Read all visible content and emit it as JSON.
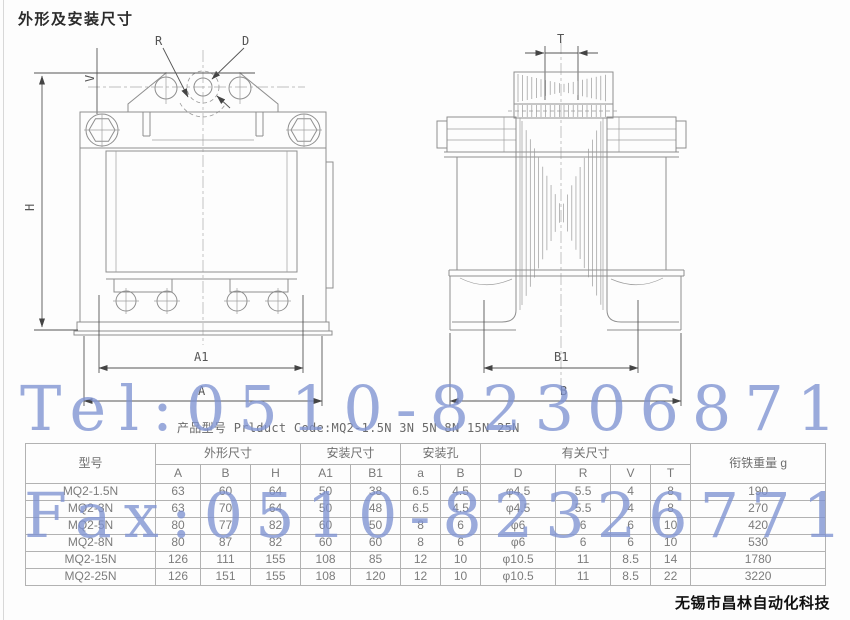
{
  "page": {
    "title": "外形及安装尺寸",
    "product_code_line": "产品型号 Prlduct Code:MQ2-1.5N 3N 5N 8N 15N 25N",
    "watermark_tel": "Tel:0510-82306871",
    "watermark_fax": "Fax:0510-82326771",
    "watermark_color": "#7f93d2",
    "footer": "无锡市昌林自动化科技"
  },
  "drawing": {
    "labels": {
      "h": "H",
      "v": "V",
      "r": "R",
      "d": "D",
      "a1": "A1",
      "a": "A",
      "t": "T",
      "b1": "B1",
      "b": "B"
    }
  },
  "table": {
    "header_groups": [
      {
        "label": "型号",
        "rowspan": 2
      },
      {
        "label": "外形尺寸",
        "colspan": 3
      },
      {
        "label": "安装尺寸",
        "colspan": 2
      },
      {
        "label": "安装孔",
        "colspan": 2
      },
      {
        "label": "有关尺寸",
        "colspan": 4
      },
      {
        "label": "衔铁重量 g",
        "rowspan": 2
      }
    ],
    "sub_headers": [
      "A",
      "B",
      "H",
      "A1",
      "B1",
      "a",
      "B",
      "D",
      "R",
      "V",
      "T"
    ],
    "rows": [
      {
        "model": "MQ2-1.5N",
        "values": [
          "63",
          "60",
          "64",
          "50",
          "38",
          "6.5",
          "4.5",
          "φ4.5",
          "5.5",
          "4",
          "8",
          "190"
        ]
      },
      {
        "model": "MQ2-3N",
        "values": [
          "63",
          "70",
          "64",
          "50",
          "48",
          "6.5",
          "4.5",
          "φ4.5",
          "5.5",
          "4",
          "8",
          "270"
        ]
      },
      {
        "model": "MQ2-5N",
        "values": [
          "80",
          "77",
          "82",
          "60",
          "50",
          "8",
          "6",
          "φ6",
          "6",
          "6",
          "10",
          "420"
        ]
      },
      {
        "model": "MQ2-8N",
        "values": [
          "80",
          "87",
          "82",
          "60",
          "60",
          "8",
          "6",
          "φ6",
          "6",
          "6",
          "10",
          "530"
        ]
      },
      {
        "model": "MQ2-15N",
        "values": [
          "126",
          "111",
          "155",
          "108",
          "85",
          "12",
          "10",
          "φ10.5",
          "11",
          "8.5",
          "14",
          "1780"
        ]
      },
      {
        "model": "MQ2-25N",
        "values": [
          "126",
          "151",
          "155",
          "108",
          "120",
          "12",
          "10",
          "φ10.5",
          "11",
          "8.5",
          "22",
          "3220"
        ]
      }
    ]
  }
}
